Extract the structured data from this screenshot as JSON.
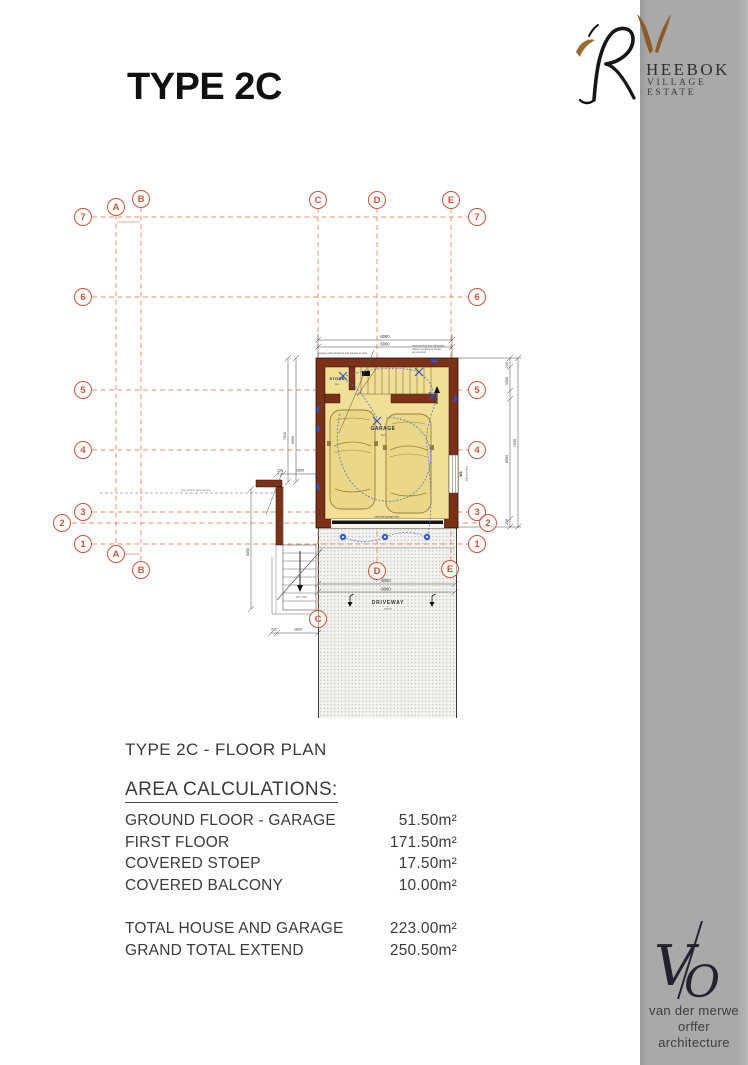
{
  "page": {
    "title": "TYPE 2C",
    "caption": "TYPE 2C - FLOOR PLAN"
  },
  "branding": {
    "estate": {
      "initial": "R",
      "name_rest": "HEEBOK",
      "subtitle": "VILLAGE ESTATE"
    },
    "architect": {
      "monogram_v": "V",
      "monogram_o": "O",
      "line1": "van der merwe",
      "line2": "orffer",
      "line3": "architecture"
    }
  },
  "grid": {
    "rows": [
      "7",
      "6",
      "5",
      "4",
      "3",
      "2",
      "1"
    ],
    "cols": [
      "A",
      "B",
      "C",
      "D",
      "E"
    ]
  },
  "plan": {
    "labels": {
      "store": "STORE",
      "store_sub": "tiles",
      "garage": "GARAGE",
      "garage_sub": "tiles",
      "driveway": "DRIVEWAY",
      "driveway_sub": "pavers",
      "garage_door": "sectional garage door",
      "window_id": "W1",
      "window_size": "1.8m x 0.6m",
      "first_floor_line": "line of first floor above",
      "stair_note": "150 x 250"
    },
    "dims": {
      "width_overall": "6060",
      "width_inner": "6000",
      "height_overall": "7940",
      "height_main": "6000",
      "height_seg": "1000",
      "wall": "230",
      "stoep_width": "1600",
      "stoep_length": "5850"
    },
    "notes": {
      "left": "garage walls plastered and painted to spec",
      "right1": "waterproofing and balustrade",
      "right2": "railing to engineers design",
      "right3": "as per detail"
    }
  },
  "area_table": {
    "heading": "AREA CALCULATIONS:",
    "rows": [
      {
        "label": "GROUND FLOOR - GARAGE",
        "value": "51.50m²"
      },
      {
        "label": "FIRST FLOOR",
        "value": "171.50m²"
      },
      {
        "label": "COVERED STOEP",
        "value": "17.50m²"
      },
      {
        "label": "COVERED BALCONY",
        "value": "10.00m²"
      }
    ],
    "totals": [
      {
        "label": "TOTAL HOUSE AND GARAGE",
        "value": "223.00m²"
      },
      {
        "label": "GRAND TOTAL EXTEND",
        "value": "250.50m²"
      }
    ]
  },
  "colors": {
    "grid_accent": "#c4563c",
    "wall": "#7b3018",
    "floor": "#f1df96",
    "electric": "#3752c8",
    "sidebar": "#a9a9a9"
  }
}
